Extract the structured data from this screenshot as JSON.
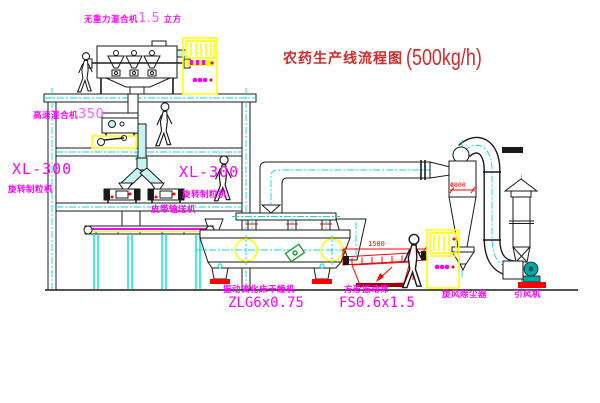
{
  "title": {
    "name": "农药生产线流程图",
    "capacity": "(500kg/h)"
  },
  "equipment_labels": {
    "gravity_mixer": {
      "name": "无重力混合机",
      "size": "1.5",
      "unit": "立方"
    },
    "high_speed_mixer": {
      "name": "高速混合机",
      "size": "350"
    },
    "granulator_left": {
      "model": "XL-300",
      "name": "旋转制粒机"
    },
    "granulator_right": {
      "model": "XL-300",
      "name": "旋转制粒机"
    },
    "belt_conveyor": {
      "name": "皮带输送机"
    },
    "fluid_bed_dryer": {
      "name": "振动流化床干燥机",
      "model": "ZLG6x0.75"
    },
    "vibrating_sieve": {
      "name": "方形振动筛",
      "model": "FS0.6x1.5"
    },
    "cyclone": {
      "name": "旋风除尘器"
    },
    "induced_draft_fan": {
      "name": "引风机"
    }
  },
  "dimensions": {
    "sieve_width": "1500",
    "cyclone_diameter": "Φ800"
  },
  "colors": {
    "label_magenta": "#ff00ff",
    "label_magenta_light": "#ff5cff",
    "title_red": "#d42a2a",
    "dim_red": "#ff0000",
    "line_black": "#1a1a1a",
    "centerline_cyan": "#00dddd",
    "cabinet_yellow": "#ffff00",
    "pipe_fill_cyan": "#c9f2f2",
    "fan_teal": "#00a8a8",
    "motor_green": "#1fa03c"
  }
}
